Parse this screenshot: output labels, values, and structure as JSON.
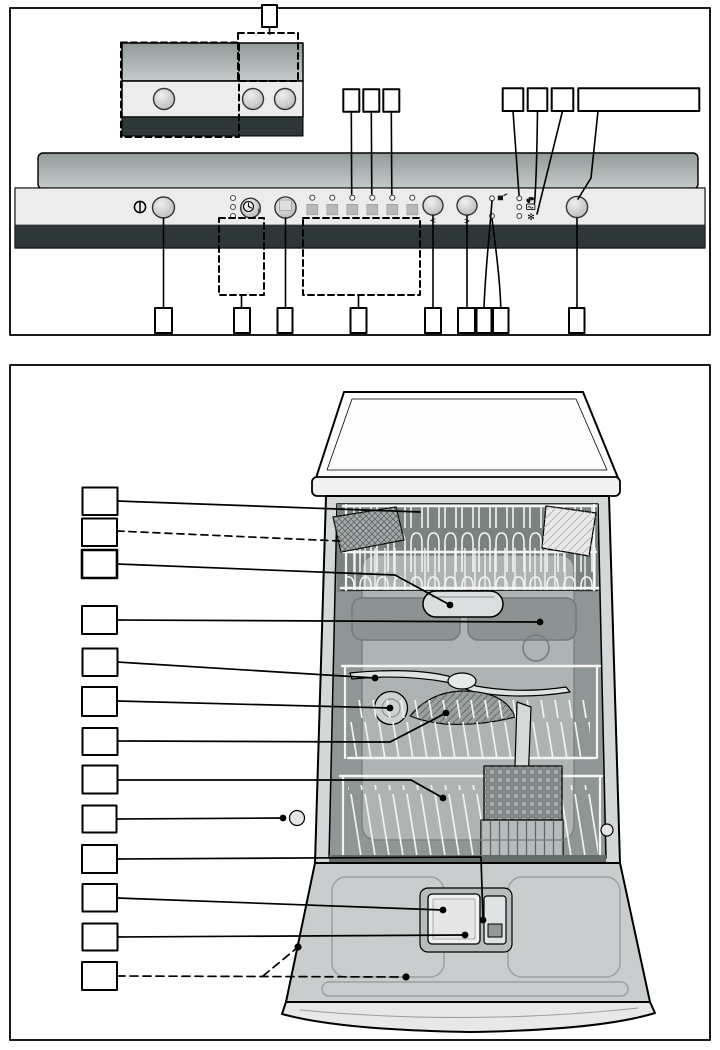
{
  "labels": {
    "prev": "<",
    "next": ">",
    "rinse_aid": "✻",
    "hour": "h"
  },
  "icons": {
    "power": "power-icon",
    "delay_timer": "clock-icon",
    "option": "option-button-icon",
    "end": "end-indicator-icon",
    "water_tap": "check-water-icon",
    "salt": "salt-refill-icon",
    "rinse": "rinse-aid-refill-icon"
  },
  "panel": {
    "status_led_count": 3,
    "program_button_count": 6,
    "program_led_count": 6,
    "indicator_led_group_a": 2,
    "indicator_led_group_b": 3
  },
  "callouts": {
    "inset_top": 1,
    "above_panel_left": 3,
    "above_panel_right": 4,
    "below_panel": 9,
    "interior_left": 13
  },
  "colors": {
    "outline": "#1a1a1a",
    "fascia": "#ececec",
    "dark_strip": "#2d3737",
    "door_top": "#929a9a",
    "door_bottom": "#c6cbcb",
    "button_light": "#f0f0f0",
    "button_dark": "#b2b2b2",
    "tub": "#8f9696",
    "tub_back": "#aeb4b4",
    "door_inner": "#c9cdcd",
    "worktop": "#fdfdfd"
  }
}
